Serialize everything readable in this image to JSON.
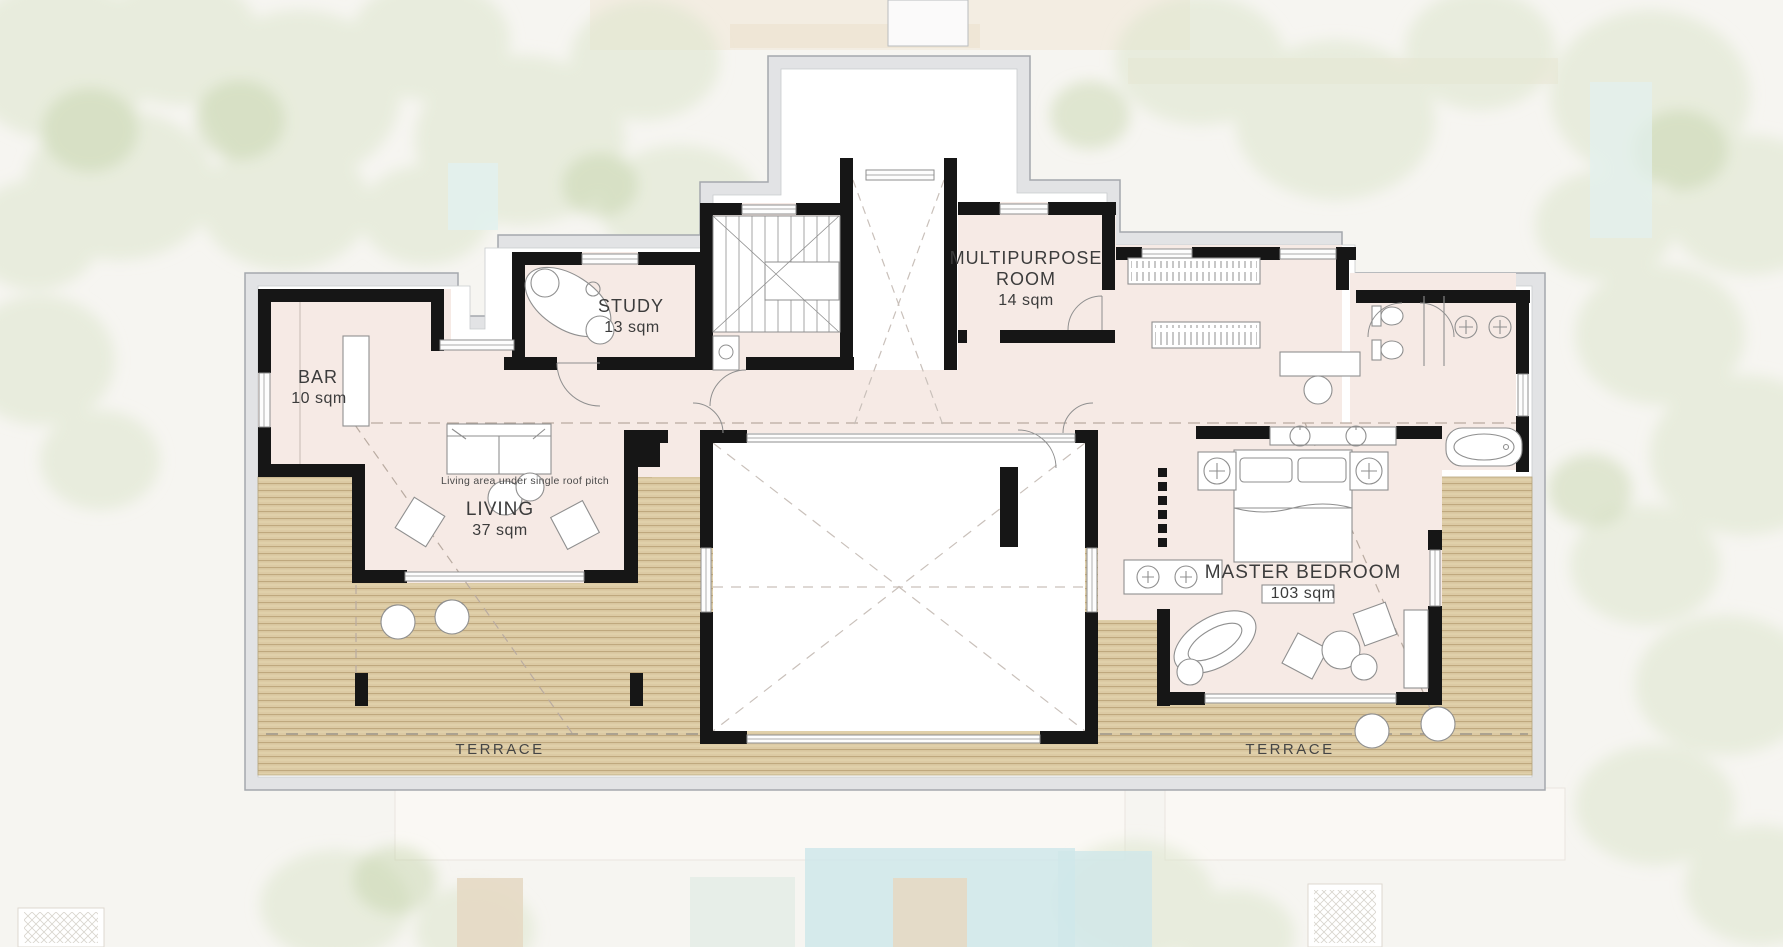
{
  "plan": {
    "type": "architectural-floor-plan",
    "rooms": {
      "bar": {
        "name": "BAR",
        "area": "10 sqm"
      },
      "study": {
        "name": "STUDY",
        "area": "13 sqm"
      },
      "multipurpose_room": {
        "name_line1": "MULTIPURPOSE",
        "name_line2": "ROOM",
        "area": "14 sqm"
      },
      "living": {
        "name": "LIVING",
        "area": "37 sqm",
        "annotation": "Living area under single roof pitch"
      },
      "master_bedroom": {
        "name": "MASTER BEDROOM",
        "area": "103 sqm"
      },
      "terrace_left": {
        "name": "TERRACE"
      },
      "terrace_right": {
        "name": "TERRACE"
      }
    },
    "colors": {
      "floor": "#f6eae5",
      "deck": "#dccaa4",
      "wall": "#161616",
      "roof_outline": "#e2e3e5",
      "pool": "#cfe7ea",
      "foliage": "#dce6cc"
    }
  }
}
